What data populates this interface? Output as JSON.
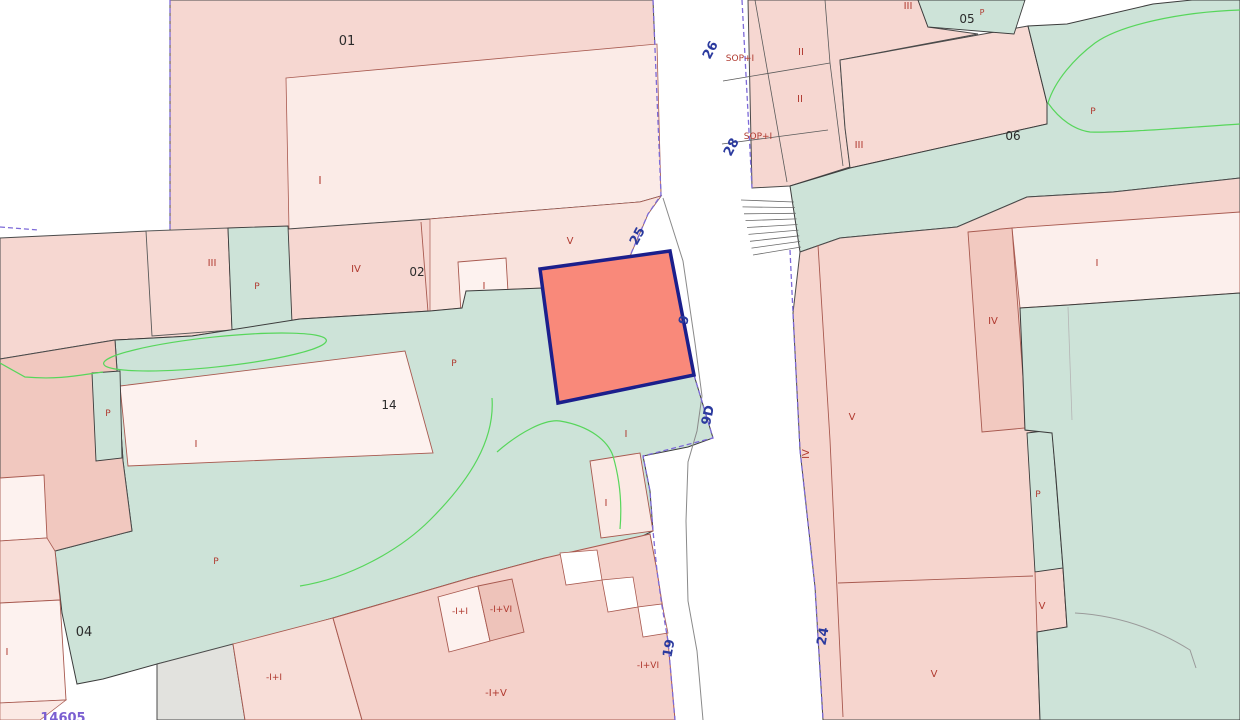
{
  "map": {
    "type": "cadastral-parcel-map",
    "background_color": "#ffffff",
    "colors": {
      "parcel_pink": "#f6d7d1",
      "parcel_pink_light": "#f9e3dd",
      "parcel_pink_pale": "#fdf2ef",
      "parcel_pink_dark": "#f1c8bf",
      "courtyard_teal": "#cde3d8",
      "grey_parcel": "#e2e2de",
      "selected_parcel_fill": "#f9897a",
      "selected_parcel_border": "#1b1f8c",
      "boundary_black": "#4a4a4a",
      "building_line_red": "#a85a50",
      "municipal_boundary_purple": "#7d6ad8",
      "vegetation_green": "#57d65b",
      "road_line_grey": "#8a8a8a",
      "street_number_blue": "#2b3a9e",
      "floor_label_red": "#b03a30",
      "parcel_number_black": "#2b2b2b",
      "ref_purple": "#7a5fd1"
    },
    "selected_parcel": {
      "description": "highlighted parcel outlined in navy at map centre"
    },
    "labels": [
      {
        "name": "parcel-number-01",
        "text": "01",
        "x": 347,
        "y": 45,
        "cls": "black",
        "size": 13
      },
      {
        "name": "floor-code-i-1",
        "text": "I",
        "x": 320,
        "y": 184,
        "cls": "red",
        "size": 11
      },
      {
        "name": "street-number-26",
        "text": "26",
        "x": 714,
        "y": 52,
        "cls": "blue",
        "size": 13,
        "rot": -62
      },
      {
        "name": "floor-code-sop-1",
        "text": "SOP+I",
        "x": 740,
        "y": 61,
        "cls": "red",
        "size": 9
      },
      {
        "name": "floor-code-ii-1",
        "text": "II",
        "x": 801,
        "y": 55,
        "cls": "red",
        "size": 10
      },
      {
        "name": "floor-code-iii-1",
        "text": "III",
        "x": 908,
        "y": 9,
        "cls": "red",
        "size": 10
      },
      {
        "name": "parcel-number-05",
        "text": "05",
        "x": 967,
        "y": 23,
        "cls": "black",
        "size": 12
      },
      {
        "name": "floor-sup-p",
        "text": "P",
        "x": 982,
        "y": 15,
        "cls": "red",
        "size": 8
      },
      {
        "name": "floor-code-ii-2",
        "text": "II",
        "x": 800,
        "y": 102,
        "cls": "red",
        "size": 10
      },
      {
        "name": "street-number-28",
        "text": "28",
        "x": 735,
        "y": 149,
        "cls": "blue",
        "size": 13,
        "rot": -62
      },
      {
        "name": "floor-code-sop-2",
        "text": "SOP+I",
        "x": 758,
        "y": 139,
        "cls": "red",
        "size": 9
      },
      {
        "name": "floor-code-iii-2",
        "text": "III",
        "x": 859,
        "y": 148,
        "cls": "red",
        "size": 10
      },
      {
        "name": "parcel-number-06",
        "text": "06",
        "x": 1013,
        "y": 140,
        "cls": "black",
        "size": 12
      },
      {
        "name": "floor-code-p-1",
        "text": "P",
        "x": 1093,
        "y": 114,
        "cls": "red",
        "size": 9
      },
      {
        "name": "floor-code-iii-3",
        "text": "III",
        "x": 212,
        "y": 266,
        "cls": "red",
        "size": 10
      },
      {
        "name": "floor-code-p-2",
        "text": "P",
        "x": 257,
        "y": 289,
        "cls": "red",
        "size": 9
      },
      {
        "name": "floor-code-iv-1",
        "text": "IV",
        "x": 356,
        "y": 272,
        "cls": "red",
        "size": 10
      },
      {
        "name": "parcel-number-02",
        "text": "02",
        "x": 417,
        "y": 276,
        "cls": "black",
        "size": 12
      },
      {
        "name": "floor-code-i-2",
        "text": "I",
        "x": 484,
        "y": 289,
        "cls": "red",
        "size": 10
      },
      {
        "name": "floor-code-v-1",
        "text": "V",
        "x": 570,
        "y": 244,
        "cls": "red",
        "size": 10
      },
      {
        "name": "street-number-25",
        "text": "25",
        "x": 641,
        "y": 238,
        "cls": "blue",
        "size": 13,
        "rot": -62
      },
      {
        "name": "street-number-9",
        "text": "9",
        "x": 688,
        "y": 321,
        "cls": "blue",
        "size": 13,
        "rot": -75
      },
      {
        "name": "floor-code-p-3",
        "text": "P",
        "x": 454,
        "y": 366,
        "cls": "red",
        "size": 9
      },
      {
        "name": "parcel-number-14",
        "text": "14",
        "x": 389,
        "y": 409,
        "cls": "black",
        "size": 12
      },
      {
        "name": "street-number-9d",
        "text": "9D",
        "x": 712,
        "y": 416,
        "cls": "blue",
        "size": 13,
        "rot": -78
      },
      {
        "name": "floor-code-i-3",
        "text": "I",
        "x": 196,
        "y": 447,
        "cls": "red",
        "size": 10
      },
      {
        "name": "floor-code-i-4",
        "text": "I",
        "x": 626,
        "y": 437,
        "cls": "red",
        "size": 10
      },
      {
        "name": "floor-code-i-5",
        "text": "I",
        "x": 1097,
        "y": 266,
        "cls": "red",
        "size": 10
      },
      {
        "name": "floor-code-iv-2",
        "text": "IV",
        "x": 993,
        "y": 324,
        "cls": "red",
        "size": 10
      },
      {
        "name": "floor-code-v-2",
        "text": "V",
        "x": 852,
        "y": 420,
        "cls": "red",
        "size": 10
      },
      {
        "name": "floor-code-iv-3",
        "text": "IV",
        "x": 809,
        "y": 454,
        "cls": "red",
        "size": 10,
        "rot": -90
      },
      {
        "name": "floor-code-p-4",
        "text": "P",
        "x": 1038,
        "y": 497,
        "cls": "red",
        "size": 9
      },
      {
        "name": "floor-code-p-5",
        "text": "P",
        "x": 108,
        "y": 416,
        "cls": "red",
        "size": 9
      },
      {
        "name": "floor-code-i-6",
        "text": "I",
        "x": 606,
        "y": 506,
        "cls": "red",
        "size": 10
      },
      {
        "name": "floor-code-p-6",
        "text": "P",
        "x": 216,
        "y": 564,
        "cls": "red",
        "size": 9
      },
      {
        "name": "floor-code-v-3",
        "text": "V",
        "x": 1042,
        "y": 609,
        "cls": "red",
        "size": 10
      },
      {
        "name": "street-number-24",
        "text": "24",
        "x": 827,
        "y": 637,
        "cls": "blue",
        "size": 13,
        "rot": -80
      },
      {
        "name": "street-number-19",
        "text": "19",
        "x": 673,
        "y": 649,
        "cls": "blue",
        "size": 13,
        "rot": -80
      },
      {
        "name": "parcel-number-04",
        "text": "04",
        "x": 84,
        "y": 636,
        "cls": "black",
        "size": 13
      },
      {
        "name": "floor-code-i-7",
        "text": "I",
        "x": 7,
        "y": 655,
        "cls": "red",
        "size": 10
      },
      {
        "name": "floor-code-b1",
        "text": "-I+I",
        "x": 460,
        "y": 614,
        "cls": "red",
        "size": 9
      },
      {
        "name": "floor-code-b2",
        "text": "-I+VI",
        "x": 501,
        "y": 612,
        "cls": "red",
        "size": 9
      },
      {
        "name": "floor-code-b3",
        "text": "-I+V",
        "x": 496,
        "y": 696,
        "cls": "red",
        "size": 10
      },
      {
        "name": "floor-code-b4",
        "text": "-I+VI",
        "x": 648,
        "y": 668,
        "cls": "red",
        "size": 9
      },
      {
        "name": "floor-code-b5",
        "text": "-I+I",
        "x": 274,
        "y": 680,
        "cls": "red",
        "size": 9
      },
      {
        "name": "floor-code-v-4",
        "text": "V",
        "x": 934,
        "y": 677,
        "cls": "red",
        "size": 10
      },
      {
        "name": "map-reference",
        "text": "14605",
        "x": 63,
        "y": 722,
        "cls": "purple",
        "size": 13,
        "weight": "bold"
      }
    ]
  }
}
